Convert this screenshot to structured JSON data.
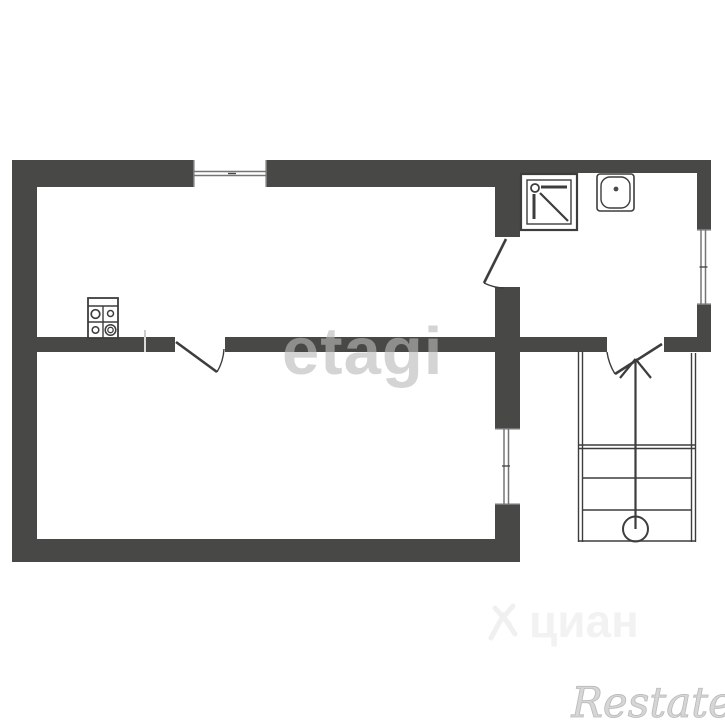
{
  "watermarks": {
    "etagi_label": "etagi",
    "cian_label": "циан",
    "restate_label": "Restate"
  },
  "colors": {
    "background": "#ffffff",
    "wall": "#484846",
    "line": "#3d3d3d",
    "window_line": "#757575",
    "tick": "#4a4a4a"
  },
  "elements": {
    "windows": [
      {
        "name": "window-top"
      },
      {
        "name": "window-right"
      },
      {
        "name": "window-lower-right"
      }
    ],
    "doors": [
      {
        "name": "door-lower-room"
      },
      {
        "name": "door-bathroom"
      },
      {
        "name": "door-staircase"
      }
    ],
    "fixtures": [
      {
        "name": "stove-icon"
      },
      {
        "name": "shower-icon"
      },
      {
        "name": "sink-icon"
      }
    ],
    "staircase": {
      "name": "staircase",
      "arrow_direction": "up",
      "steps": 4
    }
  }
}
